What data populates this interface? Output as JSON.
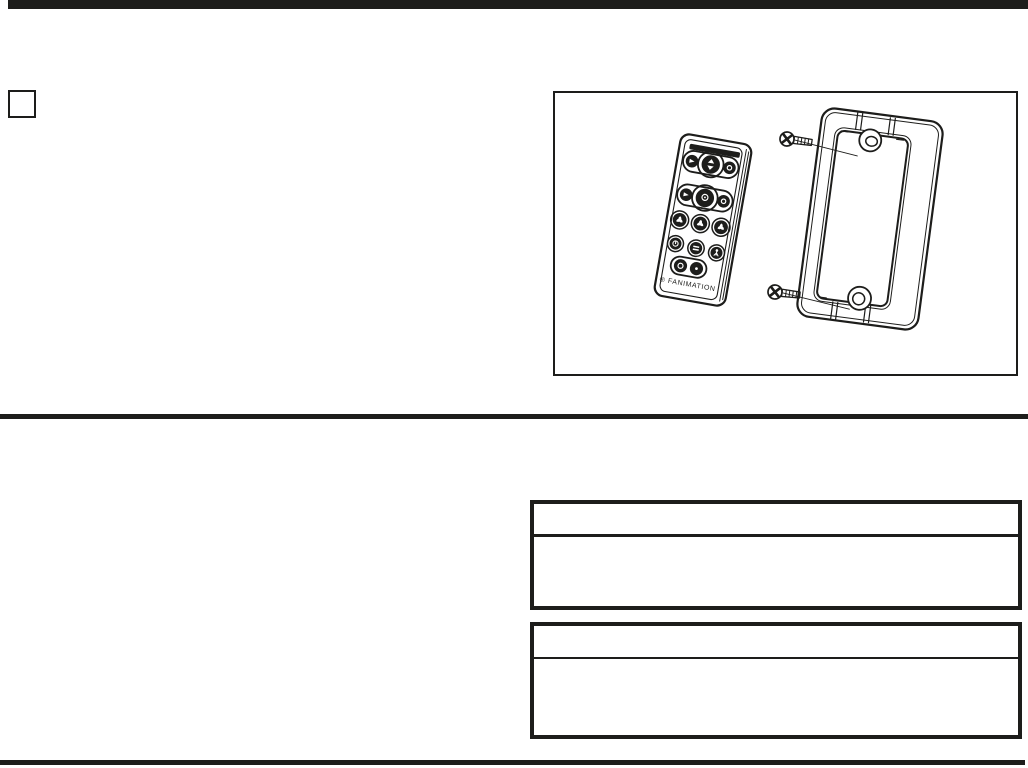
{
  "page": {
    "background": "#ffffff",
    "ink_color": "#1d1d1b",
    "kind": "instruction-sheet-page"
  },
  "step_marker": {
    "label": ""
  },
  "figure": {
    "brand_label": "® FANIMATION"
  },
  "tables": {
    "first": {
      "header_text": "",
      "body_text": ""
    },
    "second": {
      "header_text": "",
      "body_text": ""
    }
  }
}
